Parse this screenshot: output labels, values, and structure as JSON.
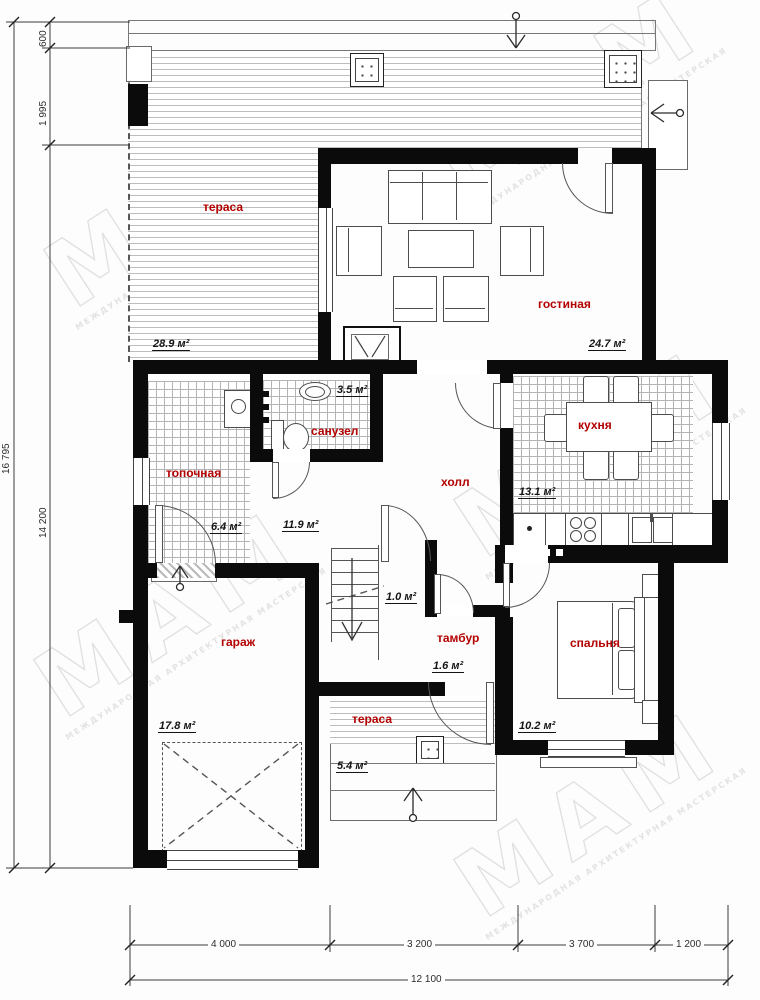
{
  "plan": {
    "rooms": [
      {
        "id": "terrace-top",
        "label": "тераса",
        "area": "28.9 м²"
      },
      {
        "id": "living-room",
        "label": "гостиная",
        "area": "24.7 м²"
      },
      {
        "id": "kitchen",
        "label": "кухня",
        "area": "13.1 м²"
      },
      {
        "id": "bathroom",
        "label": "санузел",
        "area": "3.5 м²"
      },
      {
        "id": "boiler-room",
        "label": "топочная",
        "area": "6.4 м²"
      },
      {
        "id": "hall",
        "label": "холл",
        "area": "11.9 м²"
      },
      {
        "id": "stair-closet",
        "label": "",
        "area": "1.0 м²"
      },
      {
        "id": "vestibule",
        "label": "тамбур",
        "area": "1.6 м²"
      },
      {
        "id": "garage",
        "label": "гараж",
        "area": "17.8 м²"
      },
      {
        "id": "terrace-bottom",
        "label": "тераса",
        "area": "5.4 м²"
      },
      {
        "id": "bedroom",
        "label": "спальня",
        "area": "10.2 м²"
      }
    ],
    "dimensions": {
      "left_outer_total": "16 795",
      "left_inner_total": "14 200",
      "left_top_first": "600",
      "left_top_second": "1 995",
      "bottom_segments": [
        "4 000",
        "3 200",
        "3 700",
        "1 200"
      ],
      "bottom_total": "12 100"
    },
    "watermark": {
      "big": "МАМ",
      "small": "МЕЖДУНАРОДНАЯ АРХИТЕКТУРНАЯ МАСТЕРСКАЯ"
    },
    "colors": {
      "room_label": "#b30000",
      "walls": "#0b0b0b",
      "dimension_lines": "#2c2c2c",
      "watermark": "#e0e0e0"
    }
  }
}
